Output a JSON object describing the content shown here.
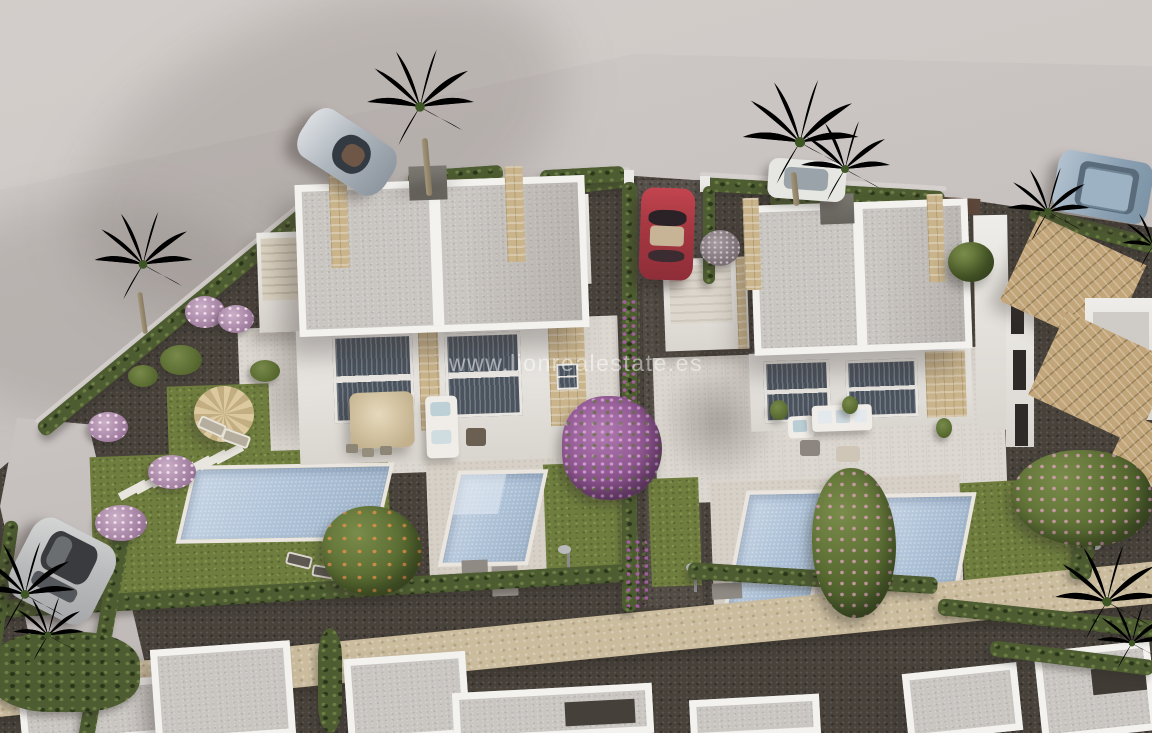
{
  "watermark": {
    "text": "www.lionrealestate.es"
  },
  "scene": {
    "kind": "aerial-3d-architectural-render",
    "subject": "two modern white duplex villas with private pools, gardens, hedges, palm trees and parked cars"
  },
  "objects": [
    "street",
    "left-duplex-villa",
    "right-duplex-villa",
    "tiled-roof-house",
    "swimming-pools",
    "lawns",
    "hedges",
    "palm-trees",
    "bougainvillea-tree",
    "orange-tree",
    "silver-sports-car",
    "red-car",
    "blue-suv",
    "white-car",
    "silver-suv",
    "garden-parasol",
    "terrace-umbrella",
    "outdoor-sofas",
    "sun-loungers",
    "stepping-stones",
    "stone-footpath",
    "neighbour-rooftops"
  ],
  "palette": {
    "street": "#c6c0be",
    "street-light": "#d5d0cd",
    "street-shadow": "#a8a19f",
    "gravel": "#48423b",
    "terrace": "#dcd7d0",
    "deck": "#d6d0c7",
    "wall-white": "#efede9",
    "wall-shadow": "#d9d5cf",
    "roof-gray": "#c9c5c1",
    "parapet": "#f3f2ef",
    "stone": "#c9b48c",
    "path-stone": "#cbbc9e",
    "pool": "#acc0d6",
    "pool-light": "#c6d4e4",
    "grass": "#6f7e3e",
    "hedge": "#4d5c31",
    "palm": "#79a04a",
    "palm-dark": "#4e6a31",
    "bougainvillea": "#a05fa3",
    "tile-roof": "#c2a67a",
    "car-red": "#a63a45",
    "car-silver": "#b9bfc5",
    "car-blue": "#93a7ba",
    "suv-silver": "#c2c3c3",
    "white-car": "#e6e6e3",
    "watermark": "rgba(255,255,255,0.5)"
  }
}
